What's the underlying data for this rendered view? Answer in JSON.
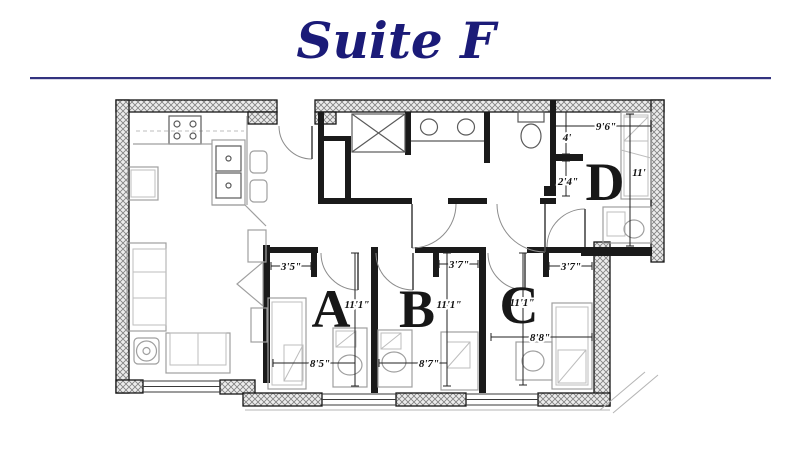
{
  "title": "Suite F",
  "colors": {
    "title_navy": "#1b1b78",
    "divider": "#33337f",
    "wall_black": "#1a1a1a",
    "furniture_gray": "#9f9f9f",
    "fixture_gray": "#5a5a5a",
    "dimension_text": "#111111"
  },
  "rooms": {
    "a": {
      "letter": "A",
      "closet_width": "3'5\"",
      "length": "11'1\"",
      "width": "8'5\""
    },
    "b": {
      "letter": "B",
      "closet_width": "3'7\"",
      "length": "11'1\"",
      "width": "8'7\""
    },
    "c": {
      "letter": "C",
      "closet_width": "3'7\"",
      "length": "11'1\"",
      "width": "8'8\""
    },
    "d": {
      "letter": "D",
      "width": "9'6\"",
      "closet_depth": "4'",
      "nook_width": "2'4\"",
      "length": "11'"
    }
  }
}
